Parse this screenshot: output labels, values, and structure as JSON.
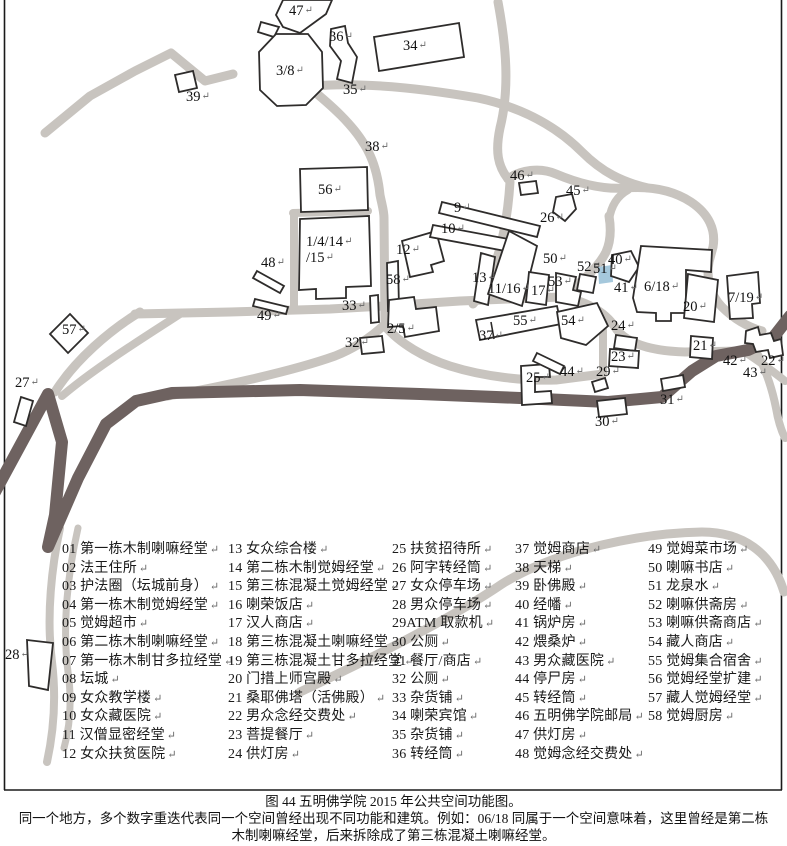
{
  "figure": {
    "caption_title": "图 44 五明佛学院 2015 年公共空间功能图。",
    "caption_note_line1": "同一个地方，多个数字重迭代表同一个空间曾经出现不同功能和建筑。例如：06/18 同属于一个空间意味着，这里曾经是第二栋",
    "caption_note_line2": "木制喇嘛经堂，后来拆除成了第三栋混凝土喇嘛经堂。"
  },
  "marks": {
    "return_mark": "↵"
  },
  "colors": {
    "road_light": "#c8c4bf",
    "road_dark": "#6e6260",
    "outline": "#2e2c2b",
    "water": "#a5c8dc",
    "text": "#111111",
    "ret": "#666666",
    "border": "#1a1a1a"
  },
  "legend": {
    "columns": [
      [
        "01 第一栋木制喇嘛经堂",
        "02 法王住所",
        "03 护法圈（坛城前身）",
        "04 第一栋木制觉姆经堂",
        "05 觉姆超市",
        "06 第二栋木制喇嘛经堂",
        "07 第一栋木制甘多拉经堂",
        "08 坛城",
        "09 女众教学楼",
        "10 女众藏医院",
        "11 汉僧显密经堂",
        "12 女众扶贫医院"
      ],
      [
        "13 女众综合楼",
        "14 第二栋木制觉姆经堂",
        "15 第三栋混凝土觉姆经堂",
        "16 喇荣饭店",
        "17 汉人商店",
        "18 第三栋混凝土喇嘛经堂",
        "19 第三栋混凝土甘多拉经堂",
        "20 门措上师宫殿",
        "21 桑耶佛塔（活佛殿）",
        "22 男众念经交费处",
        "23 菩提餐厅",
        "24 供灯房"
      ],
      [
        "25 扶贫招待所",
        "26 阿字转经筒",
        "27 女众停车场",
        "28 男众停车场",
        "29ATM 取款机",
        "30 公厕",
        "31 餐厅/商店",
        "32 公厕",
        "33 杂货铺",
        "34 喇荣宾馆",
        "35 杂货铺",
        "36 转经筒"
      ],
      [
        "37 觉姆商店",
        "38 天梯",
        "39 卧佛殿",
        "40 经幡",
        "41 锅炉房",
        "42 煨桑炉",
        "43 男众藏医院",
        "44 停尸房",
        "45 转经筒",
        "46 五明佛学院邮局",
        "47 供灯房",
        "48 觉姆念经交费处"
      ],
      [
        "49 觉姆菜市场",
        "50 喇嘛书店",
        "51 龙泉水",
        "52 喇嘛供斋房",
        "53 喇嘛供斋商店",
        "54 藏人商店",
        "55 觉姆集合宿舍",
        "56 觉姆经堂扩建",
        "57 藏人觉姆经堂",
        "58 觉姆厨房"
      ]
    ]
  },
  "map": {
    "roads_light": [
      {
        "d": "M45,133 L90,96 L135,71 L171,53 L205,81 L233,74",
        "w": 9
      },
      {
        "d": "M498,2 C506,45 510,88 500,128 C495,152 498,166 508,179",
        "w": 9
      },
      {
        "d": "M312,86 C360,82 420,88 478,98 C525,108 558,128 582,152 C602,172 622,182 648,188",
        "w": 9
      },
      {
        "d": "M310,88 C332,106 352,124 364,144 C373,158 378,175 380,195 C382,205 384,211 384,218 L385,325",
        "w": 9
      },
      {
        "d": "M293,213 L368,211",
        "w": 8
      },
      {
        "d": "M294,213 L294,310",
        "w": 8
      },
      {
        "d": "M135,314 L230,312 L330,309 L384,306 L460,301 L560,297",
        "w": 9
      },
      {
        "d": "M560,297 C580,284 598,268 606,252 C611,241 611,228 609,216",
        "w": 9
      },
      {
        "d": "M609,220 C611,206 617,196 628,190",
        "w": 8
      },
      {
        "d": "M508,179 C520,170 540,167 556,174 C575,182 600,190 626,188 C652,186 674,191 691,202 C709,214 716,230 713,247 L709,262 C706,278 710,295 722,307 C735,320 748,327 762,331",
        "w": 9
      },
      {
        "d": "M510,182 C508,215 502,248 492,272 C487,284 481,295 473,304",
        "w": 9
      },
      {
        "d": "M560,297 C585,300 605,312 615,327 C625,343 650,351 685,352 L742,351",
        "w": 9
      },
      {
        "d": "M603,330 L603,374",
        "w": 8
      },
      {
        "d": "M384,325 C368,340 350,350 335,356 C290,372 215,388 168,396",
        "w": 9
      },
      {
        "d": "M384,325 C400,344 425,358 450,366 C485,377 525,381 556,380 L603,374",
        "w": 9
      },
      {
        "d": "M140,312 C110,330 75,360 55,392",
        "w": 9
      },
      {
        "d": "M180,314 C140,340 95,368 62,396",
        "w": 8
      },
      {
        "d": "M745,352 C760,362 774,372 785,381",
        "w": 8
      },
      {
        "d": "M756,351 C765,368 772,388 776,408 C778,420 781,430 785,438",
        "w": 8
      },
      {
        "d": "M300,692 C380,654 452,618 502,584 C560,548 645,533 702,532 C742,532 772,552 784,592",
        "w": 9
      },
      {
        "d": "M60,528 C52,565 46,615 52,662 C56,695 54,730 47,762",
        "w": 8
      },
      {
        "d": "M78,528 C68,572 62,625 68,672 C72,700 70,726 64,748",
        "w": 7
      }
    ],
    "road_dark": {
      "d": "M-5,492 L48,394 L62,442 L55,515 L48,547 L78,478 L106,424 L136,401 L172,393 L300,390 L420,394 L520,398 L608,402 L662,397 L692,371 L716,356 L748,350 L772,339 L790,316",
      "w": 12
    },
    "water": {
      "points": "598,267 612,265 613,282 599,284"
    },
    "buildings": [
      {
        "name": "building-47",
        "points": "283,0 332,0 326,14 300,33 283,27 276,15"
      },
      {
        "name": "building-47-annex",
        "points": "261,22 279,27 274,37 258,32"
      },
      {
        "name": "building-36",
        "points": "331,29 345,26 348,43 357,57 352,83 337,79 341,61 330,46"
      },
      {
        "name": "building-3-8-mandala",
        "points": "276,34 308,34 322,52 323,88 306,105 277,106 260,90 259,52"
      },
      {
        "name": "building-34",
        "points": "374,37 459,23 464,57 379,71"
      },
      {
        "name": "building-39",
        "points": "175,75 193,71 197,88 179,92"
      },
      {
        "name": "building-56",
        "points": "300,169 367,167 368,210 301,212"
      },
      {
        "name": "building-1-4-14-15",
        "points": "300,219 369,216 371,286 346,287 346,298 316,299 316,289 299,290"
      },
      {
        "name": "building-48-a",
        "points": "257,271 284,286 280,293 253,278"
      },
      {
        "name": "building-48-b",
        "points": "255,299 288,307 286,314 253,306"
      },
      {
        "name": "building-12",
        "points": "402,241 436,231 444,261 431,265 433,272 410,277"
      },
      {
        "name": "building-58",
        "points": "387,263 398,261 399,309 388,311"
      },
      {
        "name": "building-33",
        "points": "370,296 378,295 379,322 371,323"
      },
      {
        "name": "building-2-5",
        "points": "389,300 414,297 416,309 436,307 439,331 405,337 403,326 388,327"
      },
      {
        "name": "building-32",
        "points": "360,338 382,336 384,352 362,354"
      },
      {
        "name": "building-9",
        "points": "442,202 540,226 537,237 439,213"
      },
      {
        "name": "building-10",
        "points": "433,225 530,243 527,255 430,237"
      },
      {
        "name": "building-26",
        "points": "556,197 572,194 576,209 565,221 553,212"
      },
      {
        "name": "building-46",
        "points": "519,183 536,181 538,193 521,195"
      },
      {
        "name": "building-40",
        "points": "612,255 631,251 639,267 629,282 611,276"
      },
      {
        "name": "building-6-18",
        "points": "641,246 712,250 711,272 686,270 686,313 671,313 671,321 656,321 656,313 637,312 633,298"
      },
      {
        "name": "building-20",
        "points": "688,274 718,280 714,322 684,318"
      },
      {
        "name": "building-7-19",
        "points": "727,276 758,272 760,303 752,304 753,318 730,319"
      },
      {
        "name": "building-13",
        "points": "481,253 495,257 488,305 474,301"
      },
      {
        "name": "building-11-16",
        "points": "509,231 537,246 522,306 488,294"
      },
      {
        "name": "building-17",
        "points": "529,272 549,275 546,305 526,302"
      },
      {
        "name": "building-53",
        "points": "556,273 576,277 573,290 581,292 578,306 556,302"
      },
      {
        "name": "building-52",
        "points": "580,274 596,277 593,293 577,290"
      },
      {
        "name": "building-55",
        "points": "476,320 557,306 561,324 480,340"
      },
      {
        "name": "building-54",
        "points": "557,312 597,303 608,326 586,345 561,338"
      },
      {
        "name": "building-21",
        "points": "691,336 713,338 712,359 690,357"
      },
      {
        "name": "building-42-cluster",
        "points": "746,331 758,327 760,335 771,333 774,341 781,339 783,355 770,358 768,350 756,352 753,344 745,343"
      },
      {
        "name": "building-23-upper",
        "points": "616,335 637,338 635,351 614,348"
      },
      {
        "name": "building-23",
        "points": "610,349 639,351 638,368 609,366"
      },
      {
        "name": "building-25",
        "points": "521,366 549,364 550,377 535,377 535,392 551,391 552,403 522,405"
      },
      {
        "name": "building-44",
        "points": "537,353 564,366 560,374 533,361"
      },
      {
        "name": "building-29",
        "points": "592,382 605,378 608,388 595,392"
      },
      {
        "name": "building-30",
        "points": "597,401 625,398 627,414 599,417"
      },
      {
        "name": "building-31",
        "points": "661,379 683,375 685,387 663,391"
      },
      {
        "name": "building-27",
        "points": "21,397 33,401 26,426 14,422"
      },
      {
        "name": "building-57",
        "points": "70,314 88,333 68,353 50,334"
      },
      {
        "name": "building-28",
        "points": "27,640 53,643 48,690 29,686"
      }
    ],
    "lines": [
      [
        491,
        322,
        494,
        339
      ]
    ],
    "labels": [
      {
        "t": "47",
        "x": 289,
        "y": 15
      },
      {
        "t": "36",
        "x": 329,
        "y": 41
      },
      {
        "t": "3/8",
        "x": 276,
        "y": 75
      },
      {
        "t": "34",
        "x": 403,
        "y": 50
      },
      {
        "t": "39",
        "x": 186,
        "y": 101
      },
      {
        "t": "35",
        "x": 343,
        "y": 94
      },
      {
        "t": "38",
        "x": 365,
        "y": 151
      },
      {
        "t": "56",
        "x": 318,
        "y": 194
      },
      {
        "t": "46",
        "x": 510,
        "y": 180
      },
      {
        "t": "45",
        "x": 566,
        "y": 195
      },
      {
        "t": "26",
        "x": 540,
        "y": 222
      },
      {
        "t": "9",
        "x": 454,
        "y": 212
      },
      {
        "t": "10",
        "x": 441,
        "y": 233
      },
      {
        "t": "1/4/14",
        "x": 306,
        "y": 246
      },
      {
        "t": "/15",
        "x": 306,
        "y": 262
      },
      {
        "t": "12",
        "x": 396,
        "y": 254
      },
      {
        "t": "48",
        "x": 261,
        "y": 267
      },
      {
        "t": "58",
        "x": 386,
        "y": 284
      },
      {
        "t": "50",
        "x": 543,
        "y": 263
      },
      {
        "t": "52",
        "x": 577,
        "y": 271
      },
      {
        "t": "51",
        "x": 593,
        "y": 273
      },
      {
        "t": "40",
        "x": 608,
        "y": 264
      },
      {
        "t": "13",
        "x": 472,
        "y": 282
      },
      {
        "t": "11/16",
        "x": 488,
        "y": 293
      },
      {
        "t": "17",
        "x": 531,
        "y": 295
      },
      {
        "t": "53",
        "x": 548,
        "y": 286
      },
      {
        "t": "41",
        "x": 614,
        "y": 292
      },
      {
        "t": "6/18",
        "x": 644,
        "y": 291
      },
      {
        "t": "20",
        "x": 683,
        "y": 311
      },
      {
        "t": "7/19",
        "x": 728,
        "y": 302
      },
      {
        "t": "49",
        "x": 257,
        "y": 320
      },
      {
        "t": "33",
        "x": 342,
        "y": 310
      },
      {
        "t": "2/5",
        "x": 387,
        "y": 333
      },
      {
        "t": "32",
        "x": 345,
        "y": 347
      },
      {
        "t": "55",
        "x": 513,
        "y": 325
      },
      {
        "t": "54",
        "x": 561,
        "y": 325
      },
      {
        "t": "37",
        "x": 479,
        "y": 340
      },
      {
        "t": "24",
        "x": 611,
        "y": 330
      },
      {
        "t": "23",
        "x": 611,
        "y": 361
      },
      {
        "t": "29",
        "x": 596,
        "y": 376
      },
      {
        "t": "44",
        "x": 560,
        "y": 376
      },
      {
        "t": "25",
        "x": 526,
        "y": 382
      },
      {
        "t": "21",
        "x": 693,
        "y": 350
      },
      {
        "t": "42",
        "x": 723,
        "y": 365
      },
      {
        "t": "22",
        "x": 761,
        "y": 365
      },
      {
        "t": "43",
        "x": 743,
        "y": 377
      },
      {
        "t": "31",
        "x": 660,
        "y": 404
      },
      {
        "t": "30",
        "x": 595,
        "y": 426
      },
      {
        "t": "27",
        "x": 15,
        "y": 387
      },
      {
        "t": "57",
        "x": 62,
        "y": 334
      },
      {
        "t": "28",
        "x": 5,
        "y": 659
      }
    ]
  }
}
